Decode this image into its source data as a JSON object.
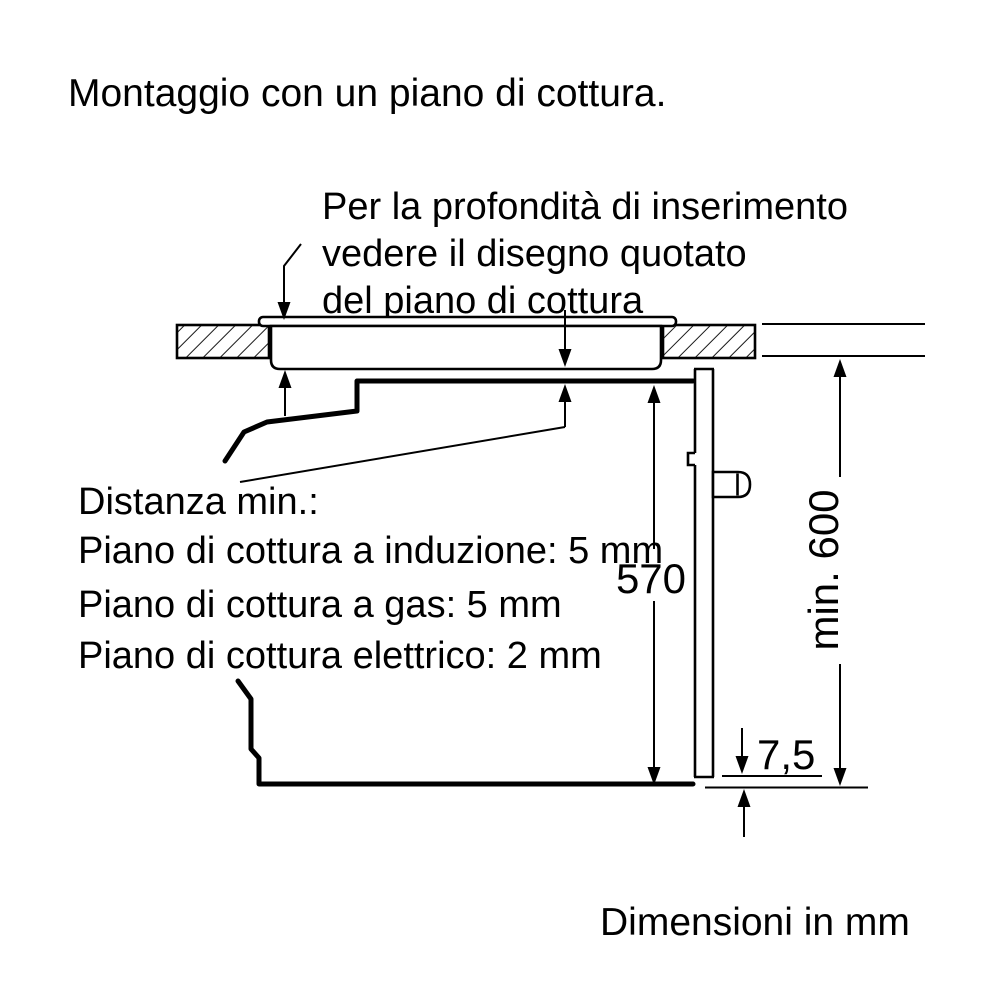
{
  "page": {
    "background": "#ffffff",
    "line_color": "#000000"
  },
  "title": "Montaggio con un piano di cottura.",
  "annotation": {
    "line1": "Per la profondità di inserimento",
    "line2": "vedere il disegno quotato",
    "line3": "del piano di cottura"
  },
  "min_distance": {
    "heading": "Distanza min.:",
    "item_induction": "Piano di cottura a induzione: 5 mm",
    "item_gas": "Piano di cottura a gas: 5 mm",
    "item_electric": "Piano di cottura elettrico: 2 mm"
  },
  "dimensions": {
    "oven_niche_height": "570",
    "min_installation_height": "min. 600",
    "bottom_gap": "7,5"
  },
  "footer": "Dimensioni in mm"
}
